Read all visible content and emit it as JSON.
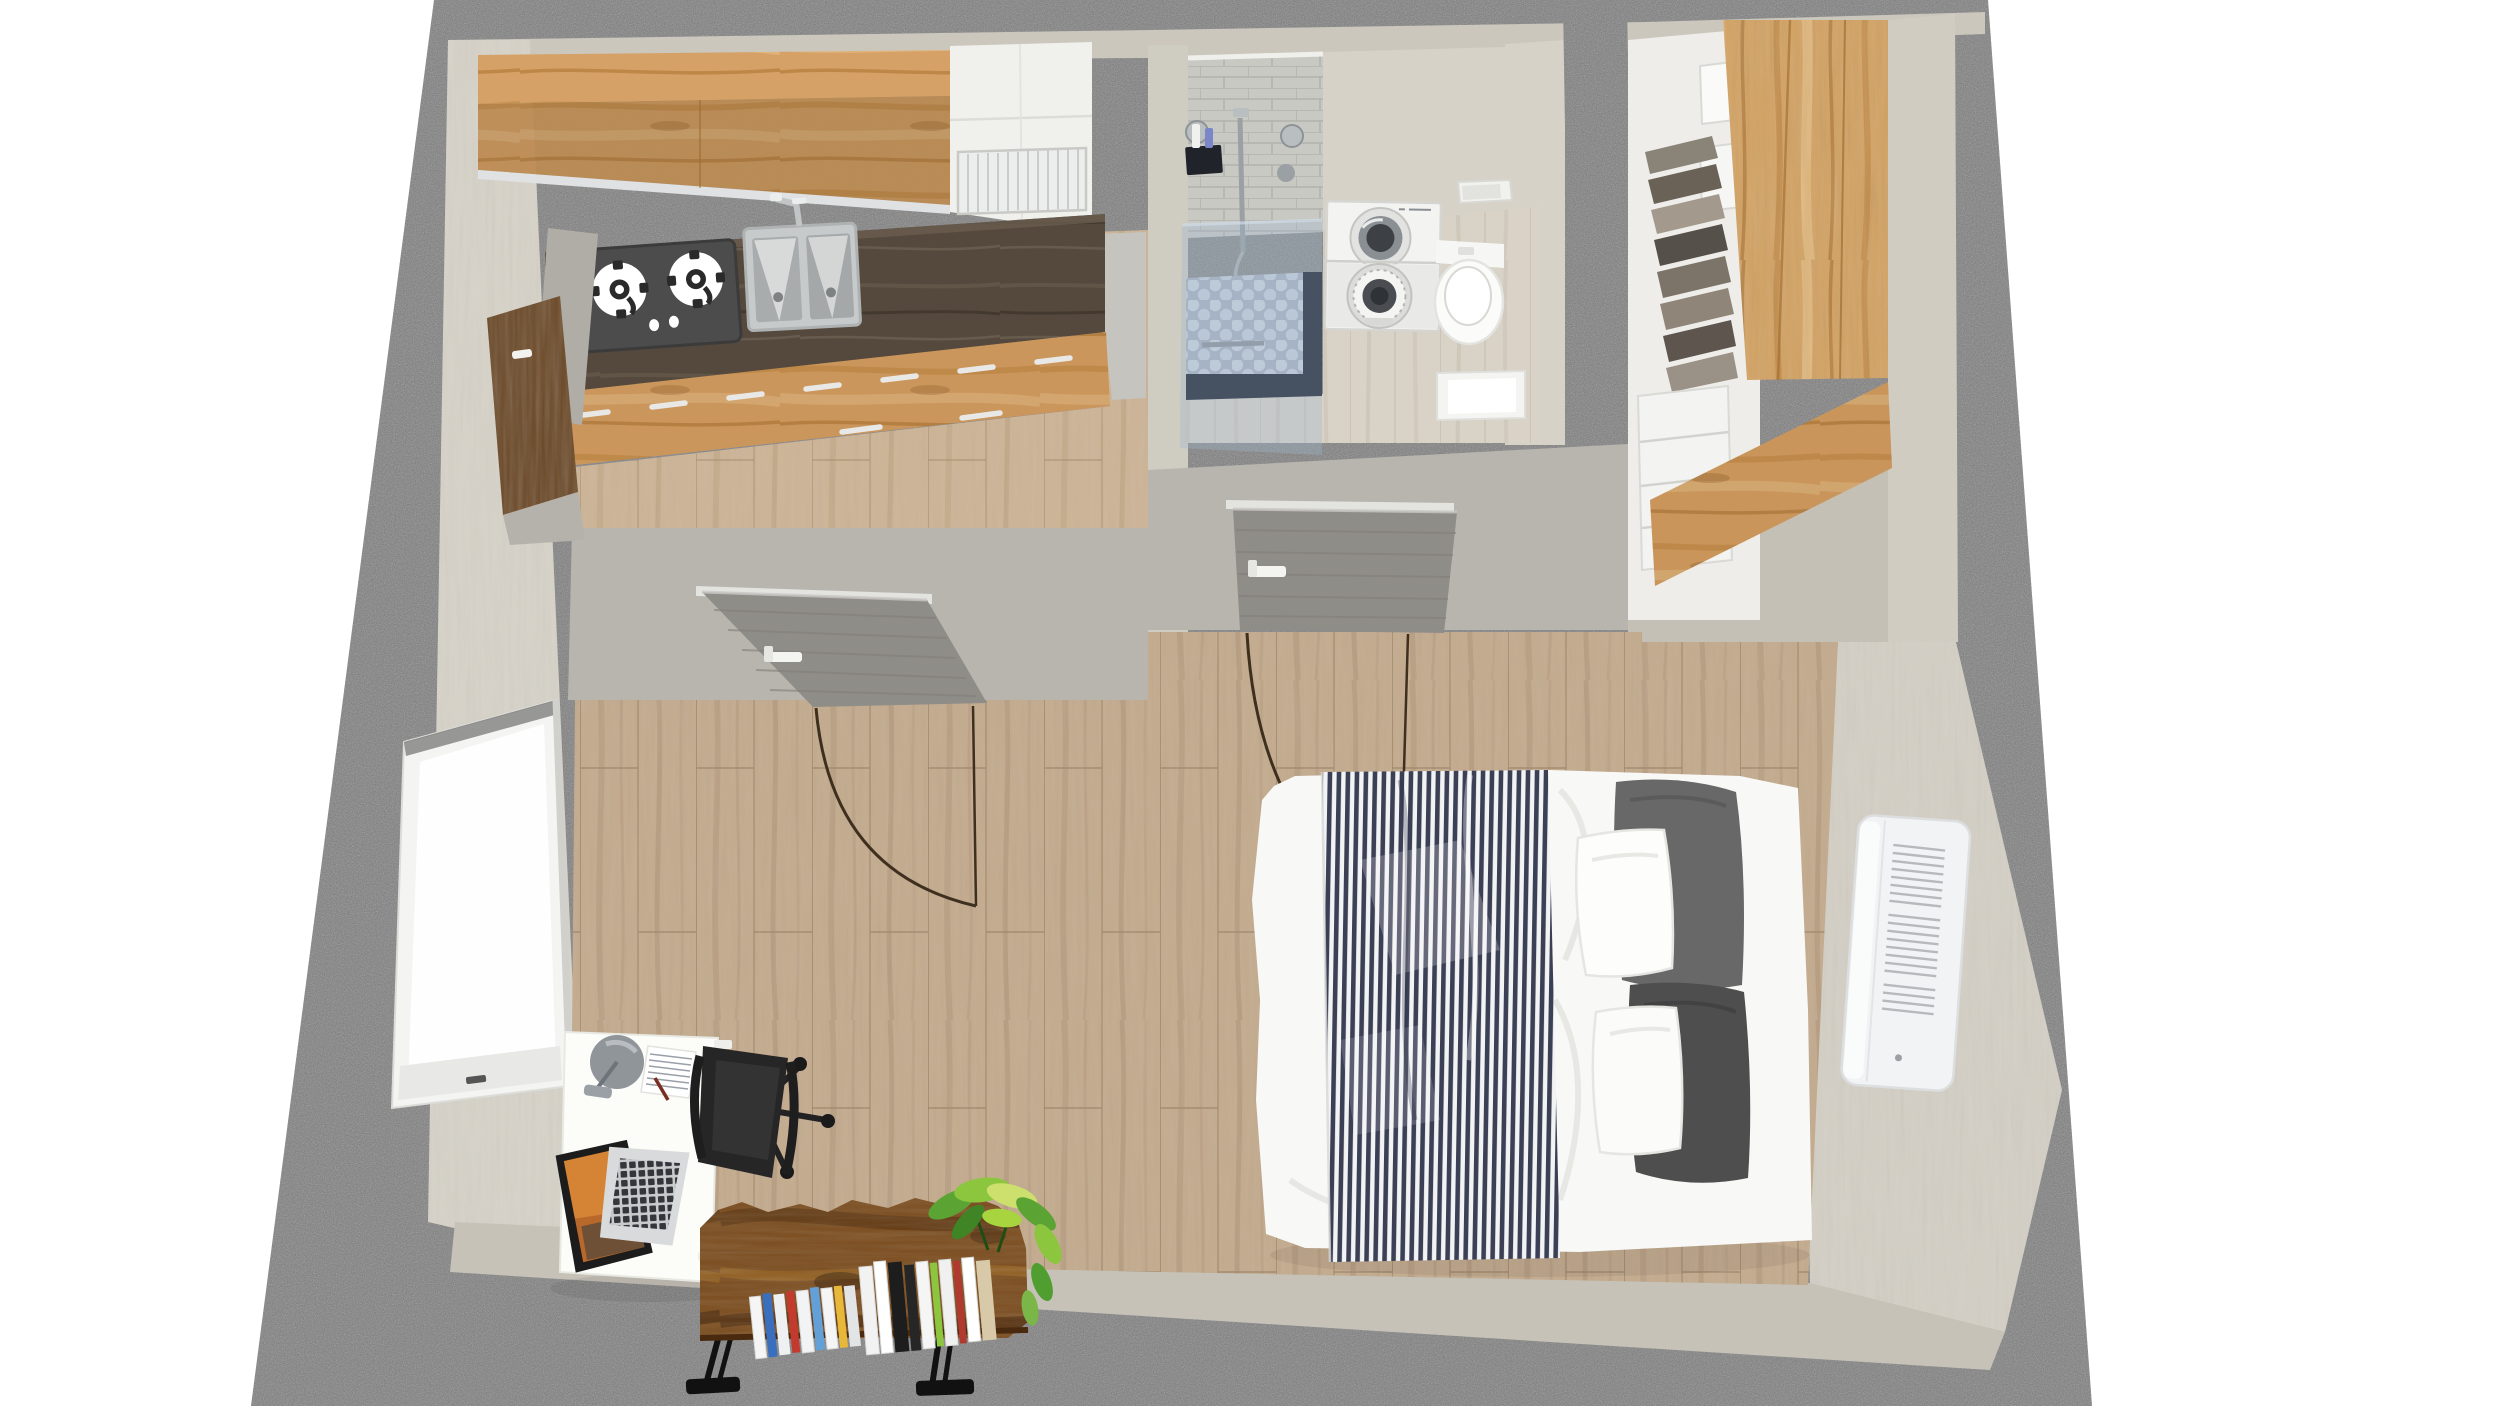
{
  "view": {
    "name": "3d-floor-plan-top-view",
    "width_px": 2500,
    "height_px": 1406,
    "background": "#ffffff"
  },
  "colors": {
    "concrete": "#7b7b7b",
    "wall_top": "#cbc7bd",
    "wall_face": "#d6d2c8",
    "wall_band": "#b8b5ae",
    "floor_main_base": "#c3ab8e",
    "floor_kitchen_base": "#ccb497",
    "floor_bath_base": "#d8d2c7",
    "cabinet_maple": "#d6a166",
    "counter_walnut": "#55493d",
    "stove_panel": "#4c4c4c",
    "stainless": "#c7cacb",
    "door_gray": "#8f8d88",
    "entry_door_brown": "#6b4826",
    "tile_wall": "#c9c9c4",
    "shower_glass": "#9fb6cf",
    "shower_frame": "#1c222e",
    "hex_tile_base": "#a8b2c0",
    "washer_white": "#f3f3f2",
    "fixture_white": "#fbfbfa",
    "closet_wood": "#d2a263",
    "closet_white": "#efede9",
    "bed_white": "#f8f8f7",
    "blanket_navy": "#3b4055",
    "blanket_white": "#f2f3f5",
    "pillow_dark_1": "#686868",
    "pillow_dark_2": "#4e4e4e",
    "ac_white": "#f2f3f4",
    "desk_white": "#fcfcf9",
    "chair_black": "#262626",
    "laptop_silver": "#d9dadb",
    "shelf_rustic": "#7b4c1d",
    "swing_arc": "#3f2f1f",
    "plant_green": "#5ba332",
    "book_palette": [
      "#f5f5f5",
      "#3a6fbe",
      "#63a0d8",
      "#e8b83a",
      "#c23b2e",
      "#1d1d1d",
      "#8cc63f",
      "#d8c9a8"
    ]
  },
  "scene": {
    "type": "apartment-3d-render",
    "rooms": [
      {
        "id": "kitchen",
        "furniture": [
          "upper-cabinets",
          "corner-cabinet",
          "dish-rack",
          "gas-cooktop",
          "kitchen-sink",
          "base-cabinets",
          "entry-door"
        ]
      },
      {
        "id": "bathroom",
        "furniture": [
          "shower",
          "shower-glass",
          "shower-tray",
          "washer-dryer",
          "toilet",
          "wall-shelf",
          "vanity"
        ]
      },
      {
        "id": "closet",
        "furniture": [
          "wardrobe",
          "hanging-clothes",
          "closet-drawers",
          "shelf-boxes"
        ]
      },
      {
        "id": "living-bedroom",
        "furniture": [
          "window",
          "interior-door-living",
          "interior-door-bedroom",
          "double-bed",
          "striped-blanket",
          "pillows",
          "air-conditioner",
          "desk",
          "desk-lamp",
          "paper-sheet",
          "laptop",
          "office-chair",
          "bookshelf",
          "books",
          "plant"
        ]
      }
    ]
  }
}
